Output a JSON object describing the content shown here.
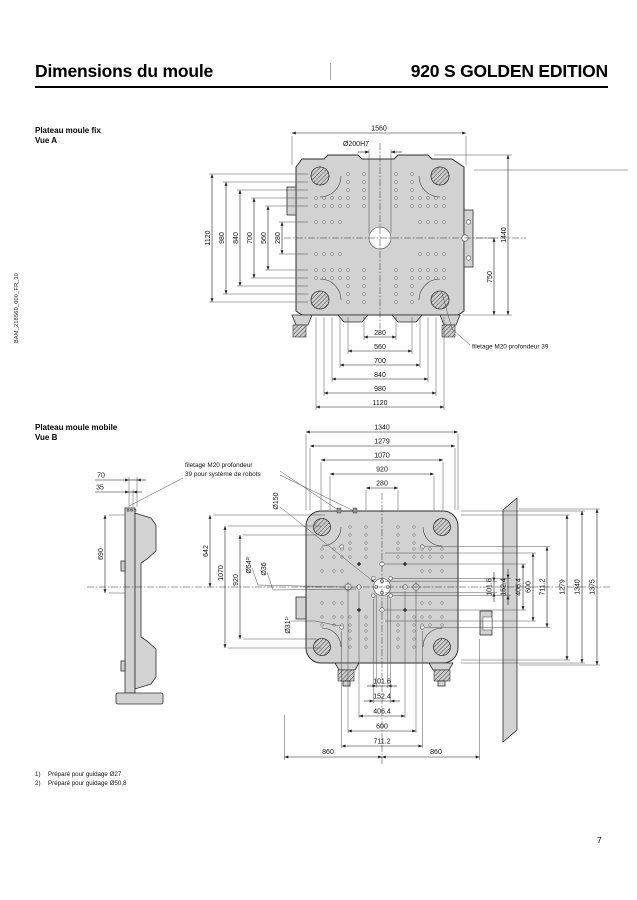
{
  "header": {
    "title": "Dimensions du moule",
    "product": "920 S GOLDEN EDITION"
  },
  "sidebar": {
    "doc_code": "BAM_218560_000_FR_10"
  },
  "drawing_a": {
    "label": "Plateau moule fix",
    "view": "Vue A",
    "center_hole_label": "Ø200H7",
    "dim_overall_width": "1560",
    "dims_left": [
      "1120",
      "980",
      "840",
      "700",
      "560",
      "280"
    ],
    "dim_overall_height": "1440",
    "dim_center_bottom": "750",
    "dims_bottom": [
      "280",
      "560",
      "700",
      "840",
      "980",
      "1120"
    ],
    "annotation": "filetage M20 profondeur 39"
  },
  "drawing_b": {
    "label": "Plateau moule mobile",
    "view": "Vue B",
    "annotation_line1": "filetage M20 profondeur",
    "annotation_line2": "39 pour système de robots",
    "side_dims": {
      "d70": "70",
      "d35": "35",
      "d690": "690"
    },
    "dims_top": [
      "1340",
      "1279",
      "1070",
      "920",
      "280"
    ],
    "dims_left": [
      "642",
      "1070",
      "920"
    ],
    "hole_labels": {
      "center": "Ø150",
      "guide54": "Ø54²⁾",
      "e36": "Ø36",
      "guide31": "Ø31¹⁾"
    },
    "dims_right_inner": [
      "101.6",
      "152.4",
      "406.4",
      "600",
      "711.2"
    ],
    "dims_right_outer": [
      "1279",
      "1340",
      "1375"
    ],
    "dims_bottom": [
      "101.6",
      "152.4",
      "406.4",
      "600",
      "711.2"
    ],
    "dims_bottom_outer": [
      "860",
      "860"
    ]
  },
  "footnotes": [
    {
      "marker": "1)",
      "text": "Préparé pour guidage Ø27"
    },
    {
      "marker": "2)",
      "text": "Préparé pour guidage Ø50,8"
    }
  ],
  "page_number": "7"
}
